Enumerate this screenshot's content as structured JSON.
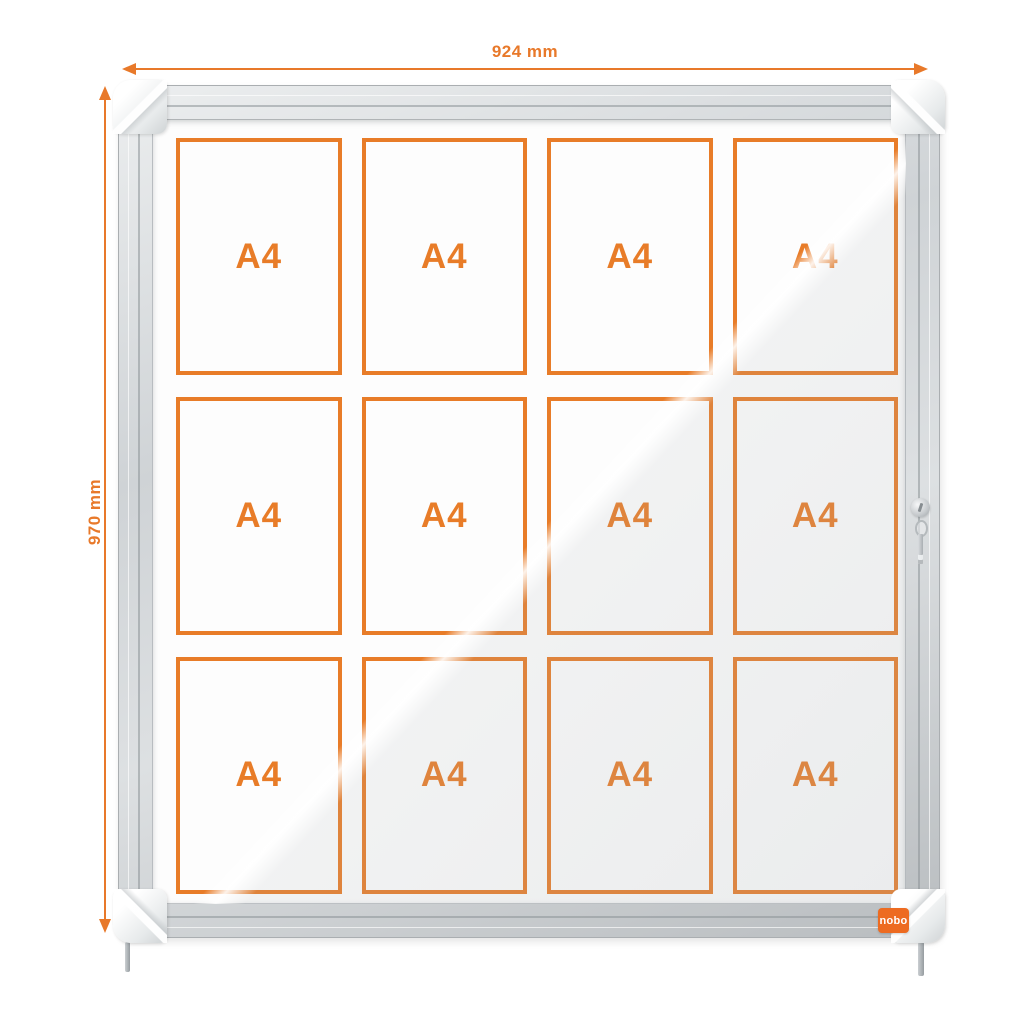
{
  "figure": {
    "type": "product-dimension-diagram",
    "subject": "lockable glazed notice board display case with 12 A4 sheets"
  },
  "dimensions": {
    "width_label": "924 mm",
    "height_label": "970 mm"
  },
  "board": {
    "brand": "nobo",
    "grid": {
      "rows": 3,
      "columns": 4
    },
    "panels": [
      {
        "label": "A4"
      },
      {
        "label": "A4"
      },
      {
        "label": "A4"
      },
      {
        "label": "A4"
      },
      {
        "label": "A4"
      },
      {
        "label": "A4"
      },
      {
        "label": "A4"
      },
      {
        "label": "A4"
      },
      {
        "label": "A4"
      },
      {
        "label": "A4"
      },
      {
        "label": "A4"
      },
      {
        "label": "A4"
      }
    ]
  },
  "colors": {
    "dimension_orange": "#E8792A",
    "panel_border_orange": "#E87C28",
    "brand_badge_orange": "#ED6B21",
    "frame_silver": "#CDD1D4",
    "background": "#FFFFFF"
  }
}
